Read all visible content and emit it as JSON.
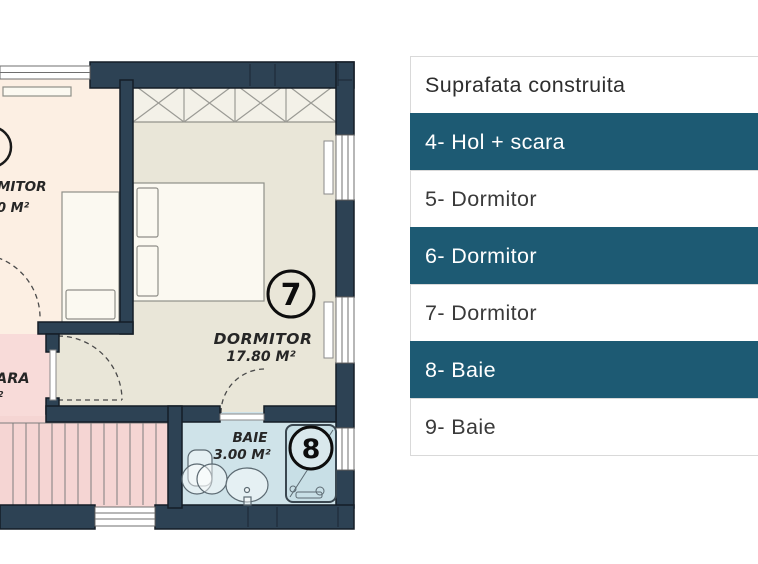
{
  "legend": {
    "header": "Suprafata construita",
    "rows": [
      {
        "label": "4- Hol + scara",
        "highlight": true
      },
      {
        "label": "5- Dormitor",
        "highlight": false
      },
      {
        "label": "6- Dormitor",
        "highlight": true
      },
      {
        "label": "7- Dormitor",
        "highlight": false
      },
      {
        "label": "8- Baie",
        "highlight": true
      },
      {
        "label": "9- Baie",
        "highlight": false
      }
    ],
    "highlight_color": "#1d5a73",
    "border_color": "#d9d9d9"
  },
  "floorplan": {
    "bedroom": {
      "number": "7",
      "name": "DORMITOR",
      "area": "17.80 M²"
    },
    "bathroom": {
      "number": "8",
      "name": "BAIE",
      "area": "3.00 M²"
    },
    "left_room_partial": {
      "name": "MITOR",
      "area": "0 M²"
    },
    "stairs_partial": {
      "name": "ARA",
      "area_fragment": "2"
    },
    "colors": {
      "wall": "#2d4254",
      "bedroom_floor": "#e9e6d8",
      "left_room_floor": "#fcefe3",
      "hall_floor": "#f8dbd9",
      "stairs_floor": "#f5d5d3",
      "bathroom_floor": "#cfe3e9"
    }
  }
}
